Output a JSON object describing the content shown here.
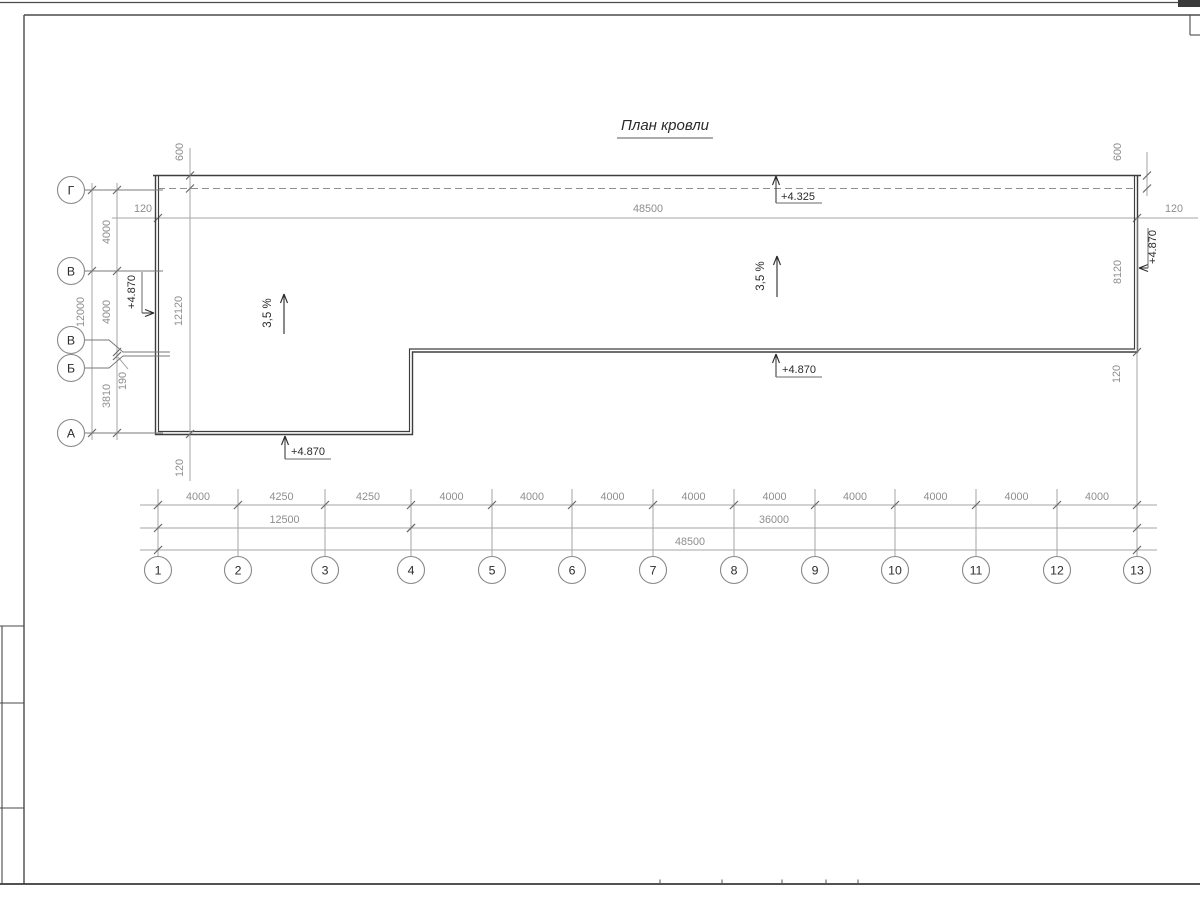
{
  "sheet": {
    "title": "План кровли",
    "title_pos": [
      665,
      130
    ],
    "title_underline": [
      617,
      138,
      713,
      138
    ],
    "stamp_row_ys": [
      626,
      703,
      808
    ],
    "bottom_ticks_x": [
      660,
      722,
      782,
      826,
      858
    ]
  },
  "colors": {
    "line": "#3e3e3e",
    "axis": "#7a7a7a",
    "dim": "#a6a6a6",
    "tick": "#6a6a6a",
    "circle": "#8a8a8a",
    "dim_text": "#8e8e8e",
    "dark_text": "#2b2b2b",
    "frame": "#4a4a4a"
  },
  "grid_cols": {
    "xs": [
      158,
      238,
      325,
      411,
      492,
      572,
      653,
      734,
      815,
      895,
      976,
      1057,
      1137
    ],
    "labels": [
      "1",
      "2",
      "3",
      "4",
      "5",
      "6",
      "7",
      "8",
      "9",
      "10",
      "11",
      "12",
      "13"
    ],
    "circle_y": 570,
    "radius": 13.5,
    "stub_top": 489,
    "stub_bottom": 556
  },
  "grid_rows": {
    "cx": 71,
    "radius": 13.5,
    "circles": [
      {
        "label": "Г",
        "cy": 190,
        "axis_y": 190,
        "bend": false
      },
      {
        "label": "В",
        "cy": 271,
        "axis_y": 271,
        "bend": false
      },
      {
        "label": "В",
        "cy": 340,
        "axis_y": 352,
        "bend": true
      },
      {
        "label": "Б",
        "cy": 368,
        "axis_y": 356,
        "bend": true
      },
      {
        "label": "А",
        "cy": 433,
        "axis_y": 433,
        "bend": false
      }
    ]
  },
  "roof": {
    "top_line": [
      153,
      175.5,
      1141,
      175.5
    ],
    "dashed_line": [
      158,
      188.5,
      1136,
      188.5
    ],
    "outer": [
      [
        155.5,
        176
      ],
      [
        155.5,
        434.5
      ],
      [
        412.5,
        434.5
      ],
      [
        412.5,
        352
      ],
      [
        1137.5,
        352
      ],
      [
        1137.5,
        176
      ]
    ],
    "inner": [
      [
        158.5,
        176
      ],
      [
        158.5,
        431.5
      ],
      [
        409.5,
        431.5
      ],
      [
        409.5,
        349
      ],
      [
        1134.5,
        349
      ],
      [
        1134.5,
        176
      ]
    ]
  },
  "dim_top": {
    "y": 218,
    "x1": 112,
    "x2": 1198,
    "ticks_x": [
      158,
      1137
    ],
    "labels": [
      {
        "t": "120",
        "x": 143,
        "y": 212
      },
      {
        "t": "48500",
        "x": 648,
        "y": 212
      },
      {
        "t": "120",
        "x": 1174,
        "y": 212
      }
    ]
  },
  "dims_bottom": {
    "x1": 140,
    "x2": 1157,
    "row1": {
      "y": 505,
      "bay_labels": [
        "4000",
        "4250",
        "4250",
        "4000",
        "4000",
        "4000",
        "4000",
        "4000",
        "4000",
        "4000",
        "4000",
        "4000"
      ]
    },
    "row2": {
      "y": 528,
      "spans": [
        {
          "i1": 0,
          "i2": 3,
          "label": "12500"
        },
        {
          "i1": 3,
          "i2": 12,
          "label": "36000"
        }
      ]
    },
    "row3": {
      "y": 550,
      "spans": [
        {
          "i1": 0,
          "i2": 12,
          "label": "48500",
          "cx": 690
        }
      ]
    }
  },
  "dims_left": {
    "line_overall": {
      "x": 92,
      "y1": 183,
      "y2": 440,
      "ticks_y": [
        190,
        271,
        433
      ],
      "labels": [
        {
          "t": "12000",
          "x": 84,
          "y": 312,
          "rot": true
        }
      ]
    },
    "line_chain": {
      "x": 117,
      "y1": 183,
      "y2": 440,
      "ticks_y": [
        190,
        271,
        352,
        356,
        433
      ],
      "labels": [
        {
          "t": "4000",
          "x": 110,
          "y": 232,
          "rot": true
        },
        {
          "t": "4000",
          "x": 110,
          "y": 312,
          "rot": true
        },
        {
          "t": "3810",
          "x": 110,
          "y": 396,
          "rot": true
        }
      ]
    },
    "label_190": {
      "t": "190",
      "x": 126,
      "y": 381,
      "rot": true,
      "leader": [
        118,
        357,
        128,
        369
      ]
    },
    "line_12120": {
      "x": 190,
      "y1": 148,
      "y2": 481,
      "ticks_y": [
        175.5,
        188.5,
        434
      ],
      "labels": [
        {
          "t": "600",
          "x": 183,
          "y": 152,
          "rot": true
        },
        {
          "t": "12120",
          "x": 182,
          "y": 311,
          "rot": true
        },
        {
          "t": "120",
          "x": 183,
          "y": 468,
          "rot": true
        }
      ]
    }
  },
  "dims_right": {
    "line_600": {
      "x": 1147,
      "y1": 152,
      "y2": 196,
      "ticks_y": [
        175.5,
        188.5
      ],
      "labels": [
        {
          "t": "600",
          "x": 1121,
          "y": 152,
          "rot": true
        }
      ]
    },
    "line_8120": {
      "x": 1137,
      "y1": 218,
      "y2": 556,
      "ticks_y": [
        352
      ],
      "labels": [
        {
          "t": "8120",
          "x": 1121,
          "y": 272,
          "rot": true
        },
        {
          "t": "120",
          "x": 1120,
          "y": 374,
          "rot": true
        }
      ]
    }
  },
  "elevations": [
    {
      "label": "+4.325",
      "type": "up",
      "tip": [
        776,
        176
      ],
      "shelf_y": 203,
      "shelf_x2": 822,
      "text": [
        798,
        200
      ]
    },
    {
      "label": "+4.870",
      "type": "up",
      "tip": [
        776,
        354
      ],
      "shelf_y": 377,
      "shelf_x2": 822,
      "text": [
        799,
        373
      ]
    },
    {
      "label": "+4.870",
      "type": "up",
      "tip": [
        285,
        436
      ],
      "shelf_y": 459,
      "shelf_x2": 331,
      "text": [
        308,
        455
      ]
    },
    {
      "label": "+4.870",
      "type": "right",
      "tip": [
        154,
        313
      ],
      "shelf_x": 142,
      "shelf_y1": 272,
      "shelf_y2": 313,
      "text": [
        135,
        292
      ]
    },
    {
      "label": "+4.870",
      "type": "left",
      "tip": [
        1139,
        268
      ],
      "shelf_x": 1148,
      "shelf_y1": 228,
      "shelf_y2": 268,
      "text": [
        1156,
        247
      ]
    }
  ],
  "slopes": [
    {
      "label": "3,5 %",
      "text": [
        271,
        313
      ],
      "arrow_x": 284,
      "arrow_y1": 334,
      "arrow_y2": 294
    },
    {
      "label": "3,5 %",
      "text": [
        764,
        276
      ],
      "arrow_x": 777,
      "arrow_y1": 297,
      "arrow_y2": 256
    }
  ]
}
